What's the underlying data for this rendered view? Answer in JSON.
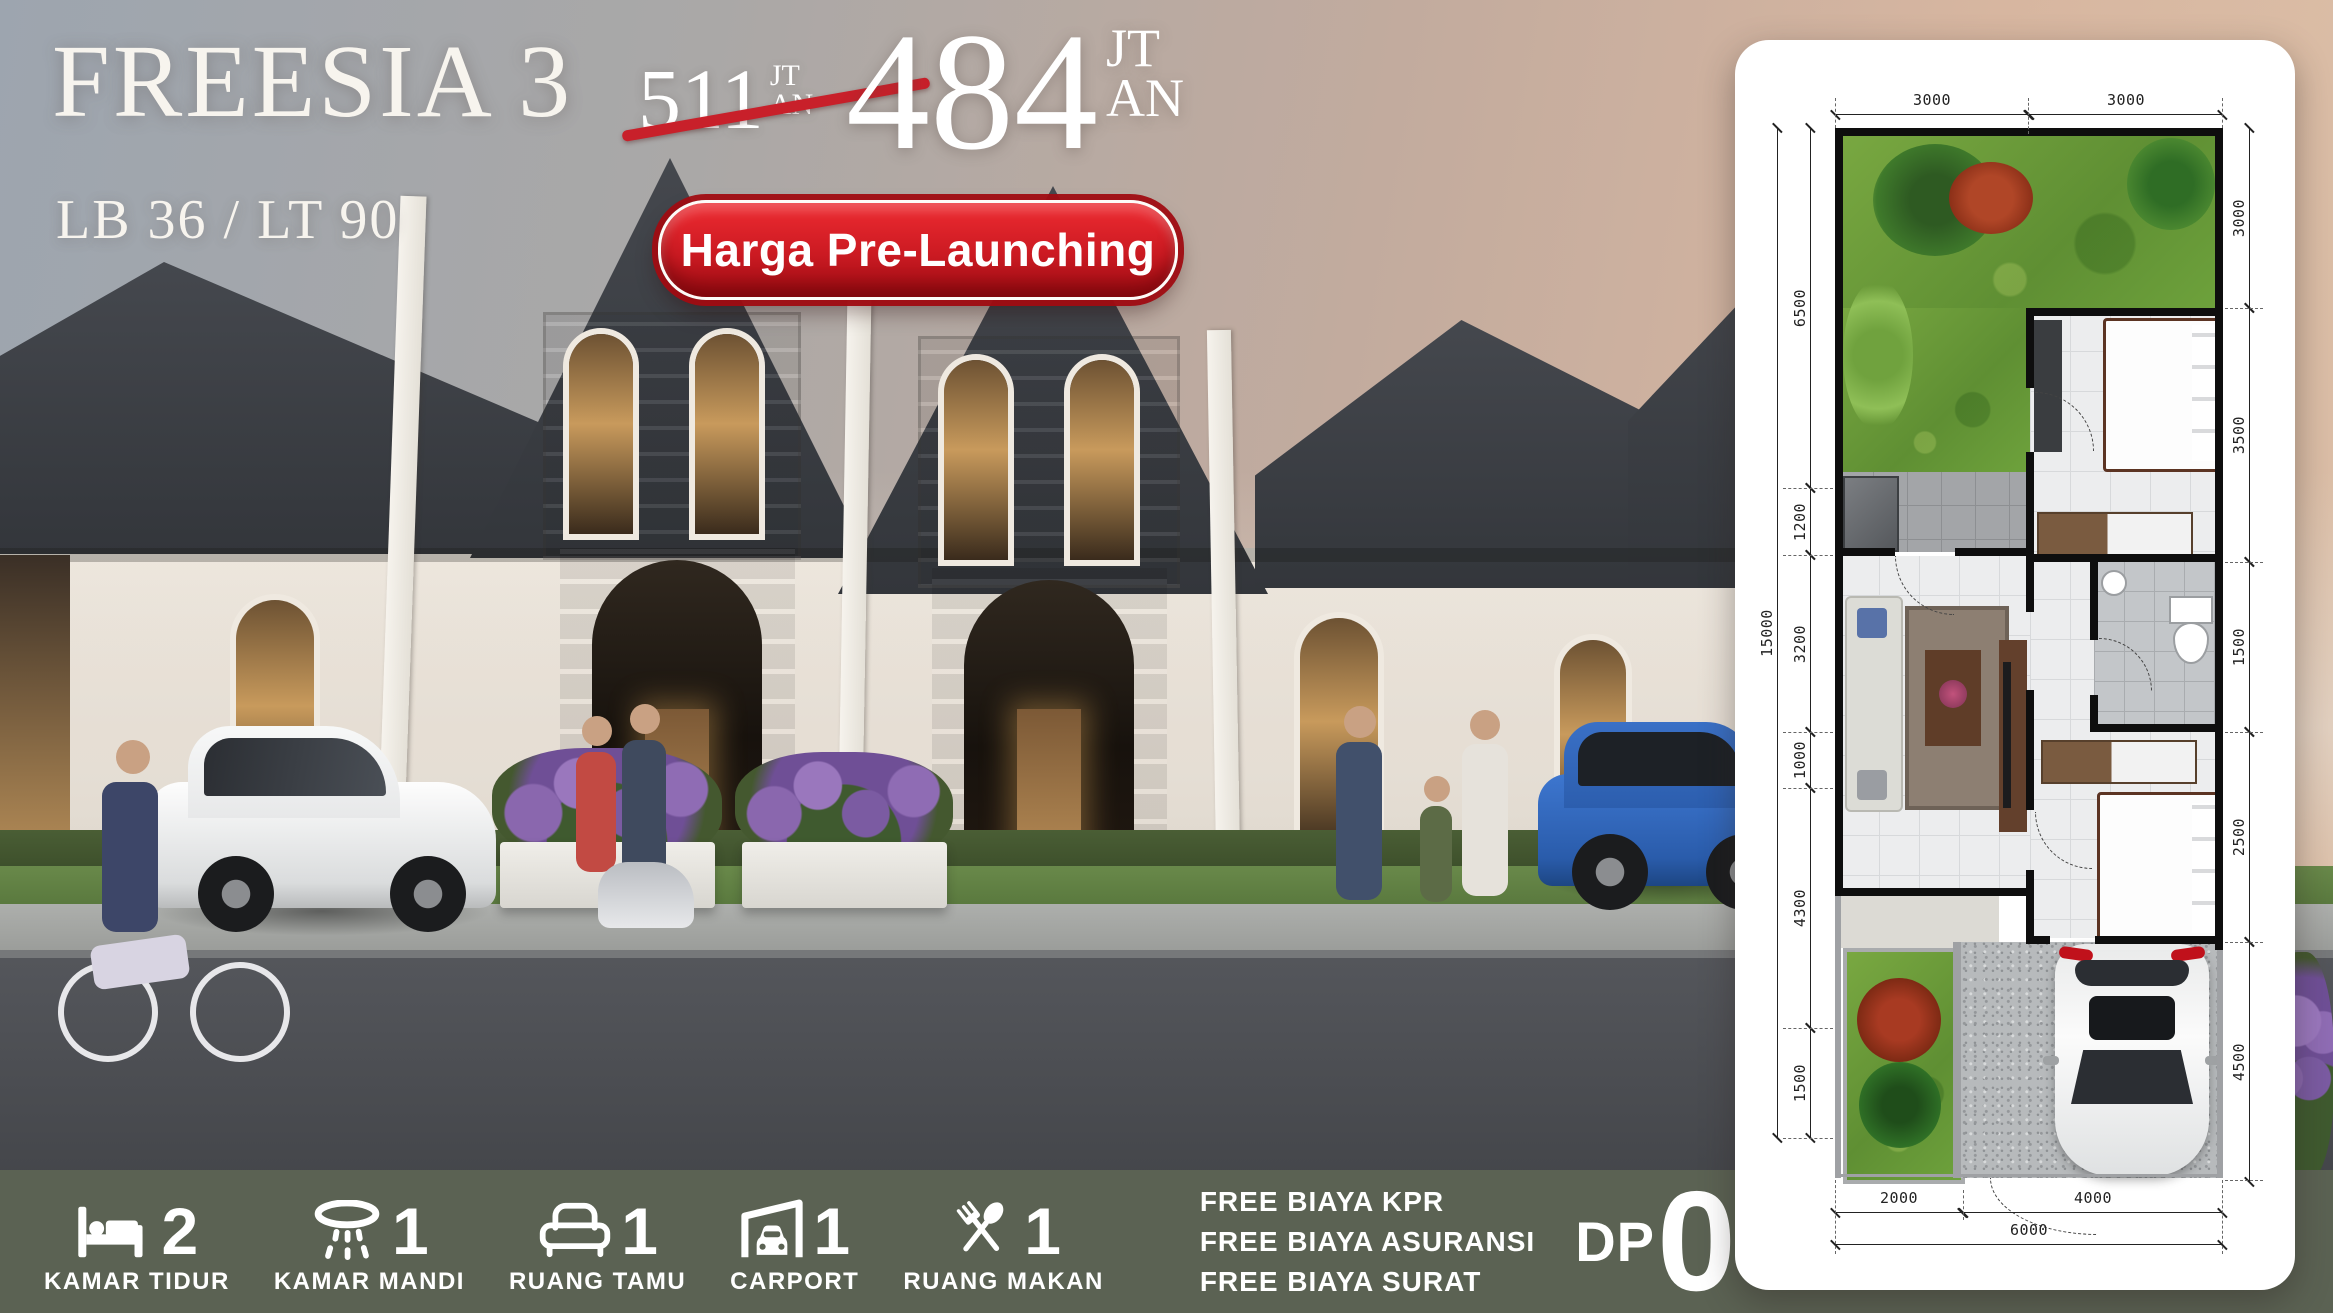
{
  "theme": {
    "accent_red": "#c8202a",
    "footer_bg": "#5b6253",
    "title_color": "#f7f4ee"
  },
  "header": {
    "title": "FREESIA 3",
    "subtitle": "LB 36 / LT 90",
    "badge": "Harga Pre-Launching",
    "old_price": {
      "value": "511",
      "unit_top": "JT",
      "unit_bottom": "AN"
    },
    "new_price": {
      "value": "484",
      "unit_top": "JT",
      "unit_bottom": "AN"
    }
  },
  "floorplan": {
    "dims_top": [
      "3000",
      "3000"
    ],
    "dims_left": [
      "6500",
      "1200",
      "3200",
      "1000",
      "4300",
      "1500"
    ],
    "left_total": "15000",
    "dims_right": [
      "3000",
      "3500",
      "1500",
      "2500",
      "4500"
    ],
    "dims_bottom": [
      "2000",
      "4000"
    ],
    "bottom_total": "6000"
  },
  "footer": {
    "features": [
      {
        "icon": "bed-icon",
        "count": "2",
        "label": "KAMAR TIDUR"
      },
      {
        "icon": "shower-icon",
        "count": "1",
        "label": "KAMAR MANDI"
      },
      {
        "icon": "sofa-icon",
        "count": "1",
        "label": "RUANG TAMU"
      },
      {
        "icon": "carport-icon",
        "count": "1",
        "label": "CARPORT"
      },
      {
        "icon": "cutlery-icon",
        "count": "1",
        "label": "RUANG MAKAN"
      }
    ],
    "free_items": [
      "FREE BIAYA KPR",
      "FREE BIAYA ASURANSI",
      "FREE BIAYA SURAT"
    ],
    "dp": {
      "prefix": "DP",
      "value": "0",
      "suffix": "%"
    }
  }
}
